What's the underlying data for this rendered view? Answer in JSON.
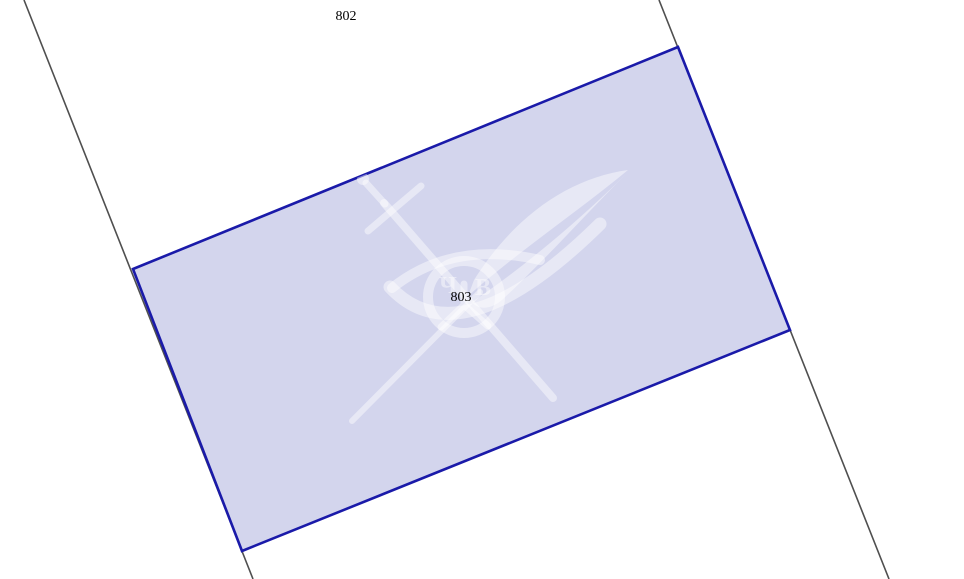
{
  "map": {
    "parcels": [
      {
        "number": "802"
      },
      {
        "number": "803"
      }
    ],
    "colors": {
      "background": "#ffffff",
      "parcel_fill": "#d3d5ed",
      "parcel_border": "#1a1aa9",
      "boundary_line": "#4f4f4f",
      "label_text": "#000000",
      "watermark": "rgba(255,255,255,0.45)"
    }
  },
  "watermark": {
    "name": "crossed-sword-and-quill-eye-emblem",
    "monogram_left": "Ч",
    "monogram_right": "В"
  }
}
